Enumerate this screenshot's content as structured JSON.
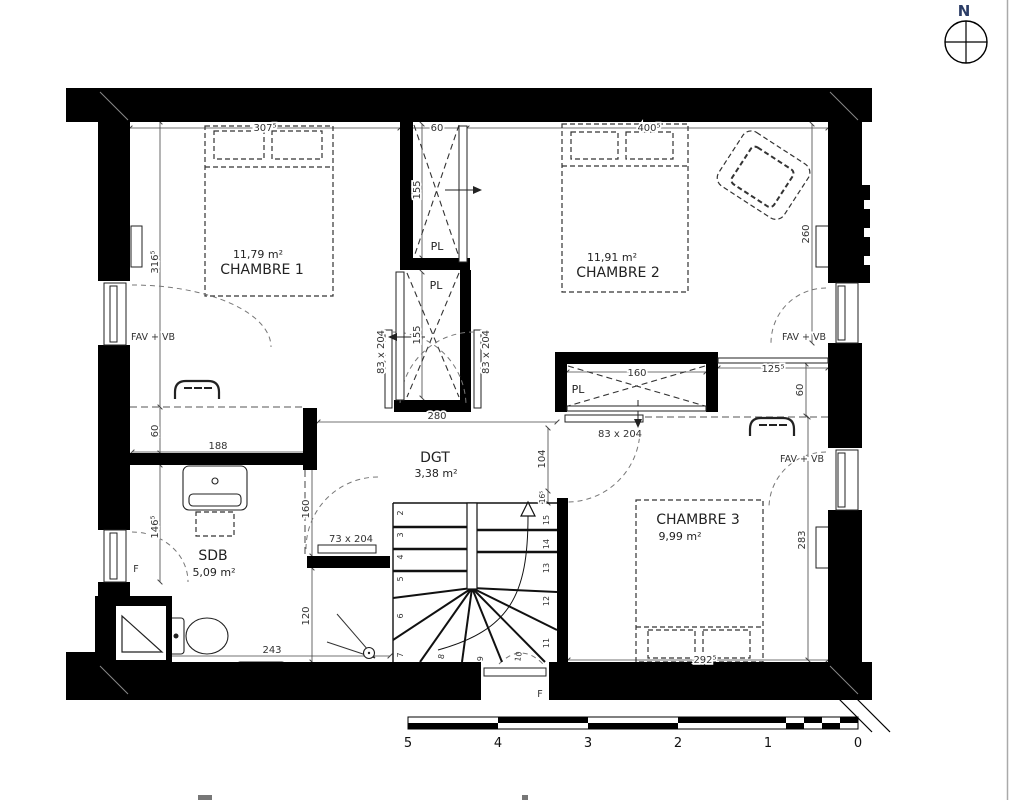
{
  "compass": {
    "north_label": "N"
  },
  "rooms": {
    "chambre1": {
      "name": "CHAMBRE 1",
      "area": "11,79 m²"
    },
    "chambre2": {
      "name": "CHAMBRE 2",
      "area": "11,91 m²"
    },
    "chambre3": {
      "name": "CHAMBRE 3",
      "area": "9,99 m²"
    },
    "sdb": {
      "name": "SDB",
      "area": "5,09 m²"
    },
    "dgt": {
      "name": "DGT",
      "area": "3,38 m²"
    },
    "closets": {
      "pl_top": "PL",
      "pl_bottom": "PL",
      "pl_right": "PL"
    }
  },
  "dimensions": {
    "ch1_width": "307⁵",
    "pl_width": "60",
    "ch2_width": "400⁵",
    "ch1_height": "316⁵",
    "left_offset": "60",
    "sdb_window": "146⁵",
    "pl_top_depth": "155",
    "pl_bottom_depth": "155",
    "door_left": "83 x 204",
    "door_right": "83 x 204",
    "door_ch3": "83 x 204",
    "door_sdb": "73 x 204",
    "dgt_width": "280",
    "sdb_wall": "188",
    "sdb_width": "243",
    "sdb_mid": "160",
    "sdb_low": "120",
    "stair_offset": "104",
    "stair_small": "16⁵",
    "pl_right_width": "160",
    "ch3_corridor": "125⁵",
    "ch3_offset": "60",
    "ch2_height": "260",
    "ch3_height": "283",
    "ch3_width": "292⁵"
  },
  "windows": {
    "fav_vb_left": "FAV + VB",
    "fav_vb_right_1": "FAV + VB",
    "fav_vb_right_2": "FAV + VB",
    "f_left": "F",
    "f_bottom": "F"
  },
  "stairs": {
    "steps": [
      "2",
      "3",
      "4",
      "5",
      "6",
      "7",
      "8",
      "9",
      "10",
      "11",
      "12",
      "13",
      "14",
      "15"
    ]
  },
  "scale_bar": {
    "labels": [
      "5",
      "4",
      "3",
      "2",
      "1",
      "0"
    ]
  },
  "colors": {
    "wall": "#000000",
    "north": "#2b3d66",
    "dimension_text": "#333333"
  }
}
